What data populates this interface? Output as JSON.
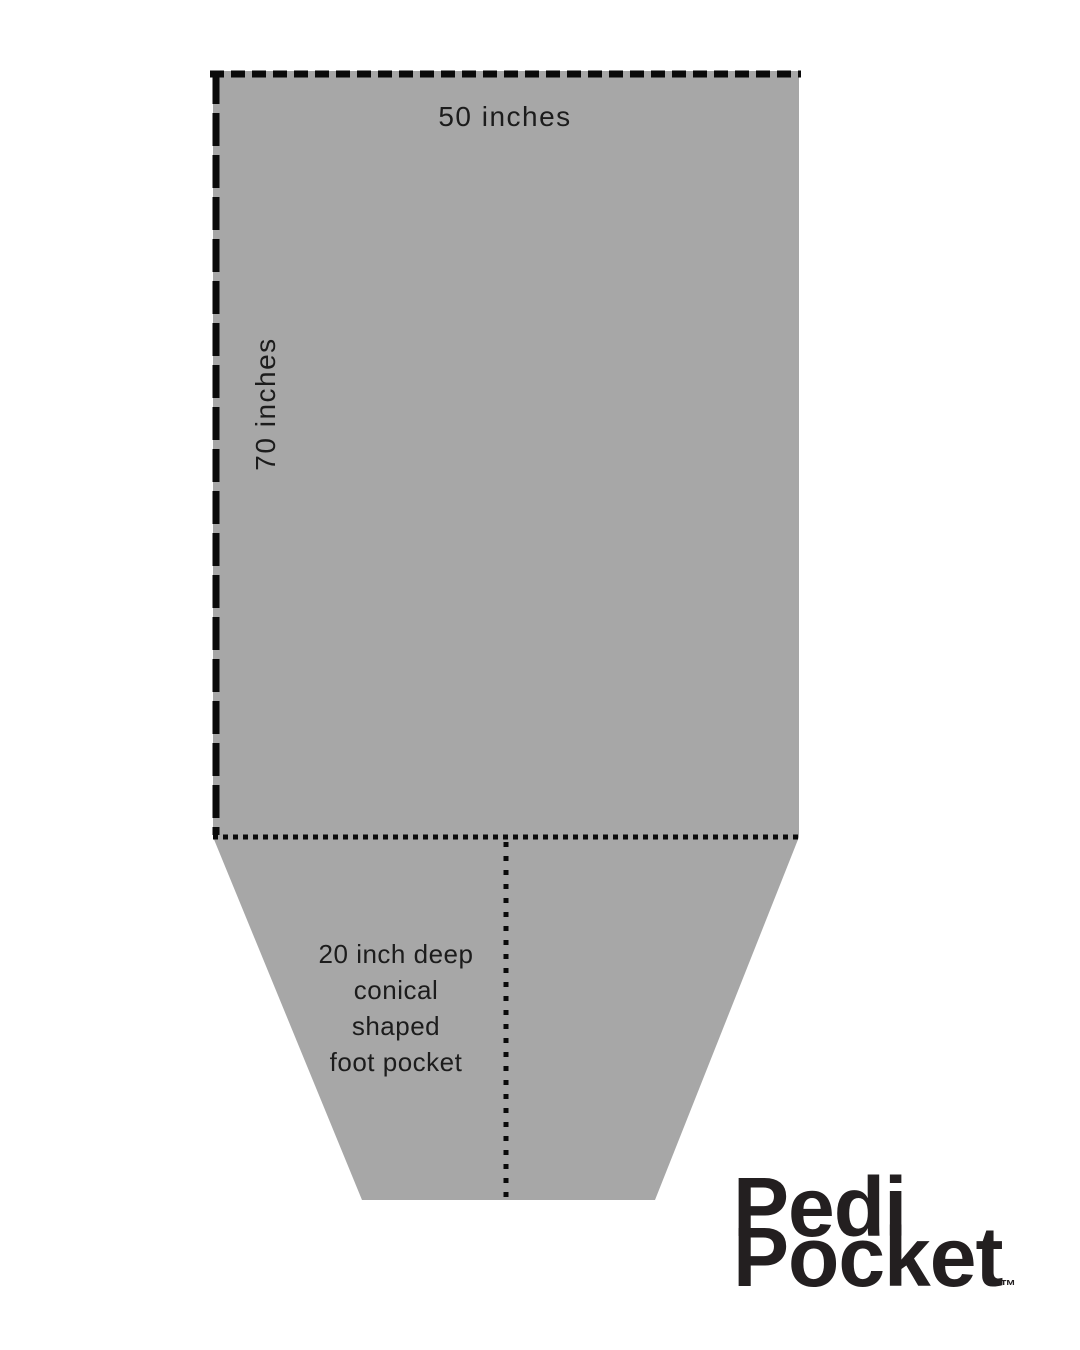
{
  "figure": {
    "top_width_label": "50 inches",
    "side_height_label": "70 inches",
    "pocket_note": {
      "line1": "20 inch deep",
      "line2": "conical",
      "line3": "shaped",
      "line4": "foot pocket"
    }
  },
  "logo": {
    "word1": "Pedi",
    "word2": "Pocket",
    "trademark": "™"
  },
  "colors": {
    "fabric_gray": "#a7a7a7",
    "line_black": "#0a0a0a",
    "text_black": "#1c1c1c",
    "logo_black": "#231f20",
    "background": "#ffffff"
  }
}
